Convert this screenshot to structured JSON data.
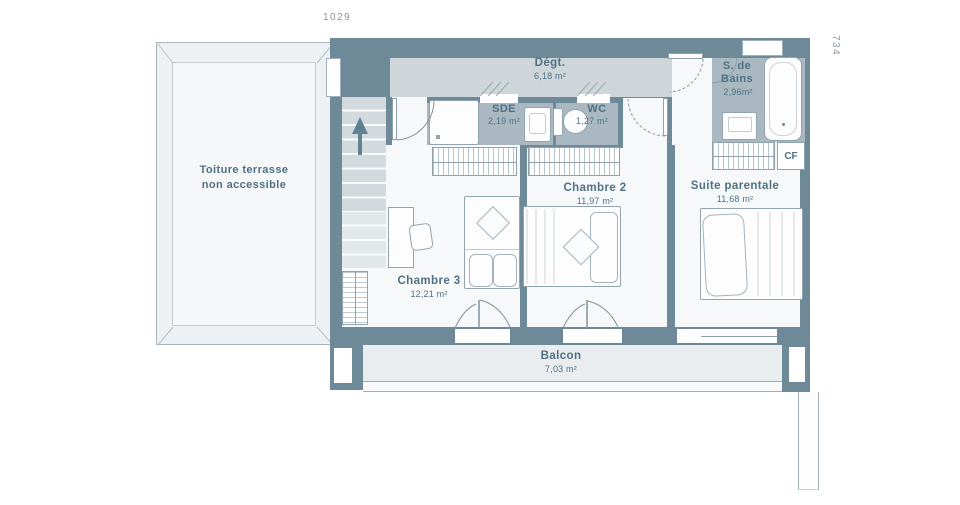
{
  "plan": {
    "dimension_top": "1029",
    "dimension_right": "734",
    "terrace": {
      "line1": "Toiture terrasse",
      "line2": "non accessible"
    },
    "rooms": {
      "degt": {
        "name": "Dégt.",
        "area": "6,18 m²"
      },
      "sde": {
        "name": "SDE",
        "area": "2,19 m²"
      },
      "wc": {
        "name": "WC",
        "area": "1,27 m²"
      },
      "bains": {
        "line1": "S. de",
        "line2": "Bains",
        "area": "2,96m²"
      },
      "cf": {
        "name": "CF"
      },
      "chambre2": {
        "name": "Chambre 2",
        "area": "11,97 m²"
      },
      "chambre3": {
        "name": "Chambre 3",
        "area": "12,21 m²"
      },
      "suite": {
        "name": "Suite parentale",
        "area": "11,68 m²"
      },
      "balcon": {
        "name": "Balcon",
        "area": "7,03 m²"
      }
    }
  },
  "colors": {
    "wall": "#6e8a99",
    "wet": "#a9b8c1",
    "corridor": "#cfd6da",
    "room": "#f7f8f9",
    "balcony": "#e9edef",
    "terrace": "#eef1f3",
    "label": "#4e7183",
    "dim": "#8796a1"
  }
}
